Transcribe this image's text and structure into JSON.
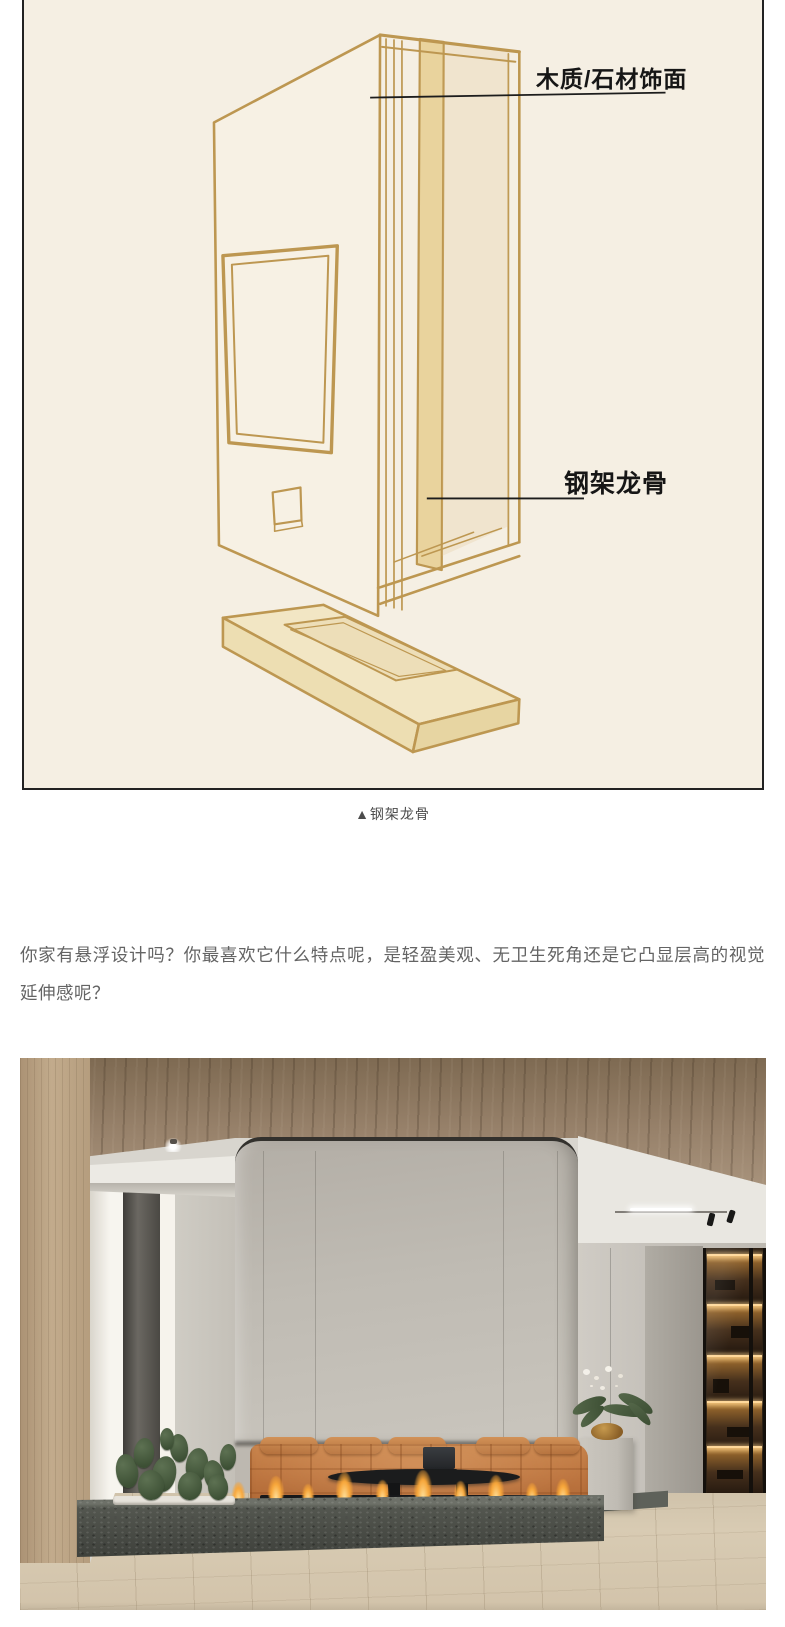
{
  "figure": {
    "name": "悬浮电视墙结构示意图",
    "labels": [
      {
        "text": "木质/石材饰面"
      },
      {
        "text": "钢架龙骨"
      }
    ],
    "caption": "▲钢架龙骨",
    "colors": {
      "background": "#f5efe3",
      "sketch_line": "#bd9751",
      "post_fill": "#e9d39d",
      "border": "#222222",
      "label_text": "#161616",
      "caption_text": "#4c4c4c"
    }
  },
  "article": {
    "paragraph": "你家有悬浮设计吗？你最喜欢它什么特点呢，是轻盈美观、无卫生死角还是它凸显层高的视觉延伸感呢？",
    "text_color": "#646464"
  },
  "photo": {
    "description": "悬浮壁炉电视墙客厅实景效果图",
    "colors": {
      "wood_ceiling": "#97816a",
      "wood_wall": "#c2ab8c",
      "column": "#c0bbb3",
      "sofa": "#bd7540",
      "stone": "#53564f",
      "flame": "#f7a63a",
      "floor": "#d4c6ae"
    }
  }
}
